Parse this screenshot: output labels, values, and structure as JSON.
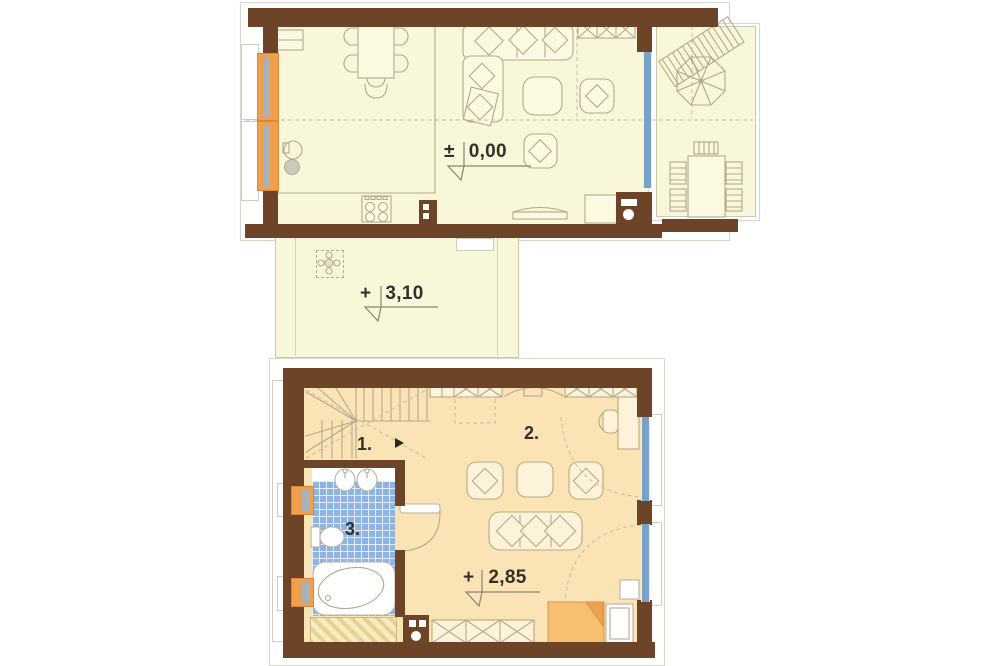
{
  "ground_floor": {
    "elevation_sign": "±",
    "elevation_value": "0,00"
  },
  "landing": {
    "elevation_sign": "+",
    "elevation_value": "3,10"
  },
  "upper_floor": {
    "elevation_sign": "+",
    "elevation_value": "2,85",
    "room_labels": {
      "stairs": "1.",
      "living": "2.",
      "bathroom": "3."
    }
  },
  "colors": {
    "wall_brown": "#6d4428",
    "floor_cream": "#f9f7d9",
    "floor_peach": "#fae3b4",
    "window_orange": "#f09f4b",
    "window_blue": "#79a2ca",
    "tile_blue": "#8db4e2",
    "bed_orange": "#f7c071",
    "linework": "#b2aa8e"
  }
}
